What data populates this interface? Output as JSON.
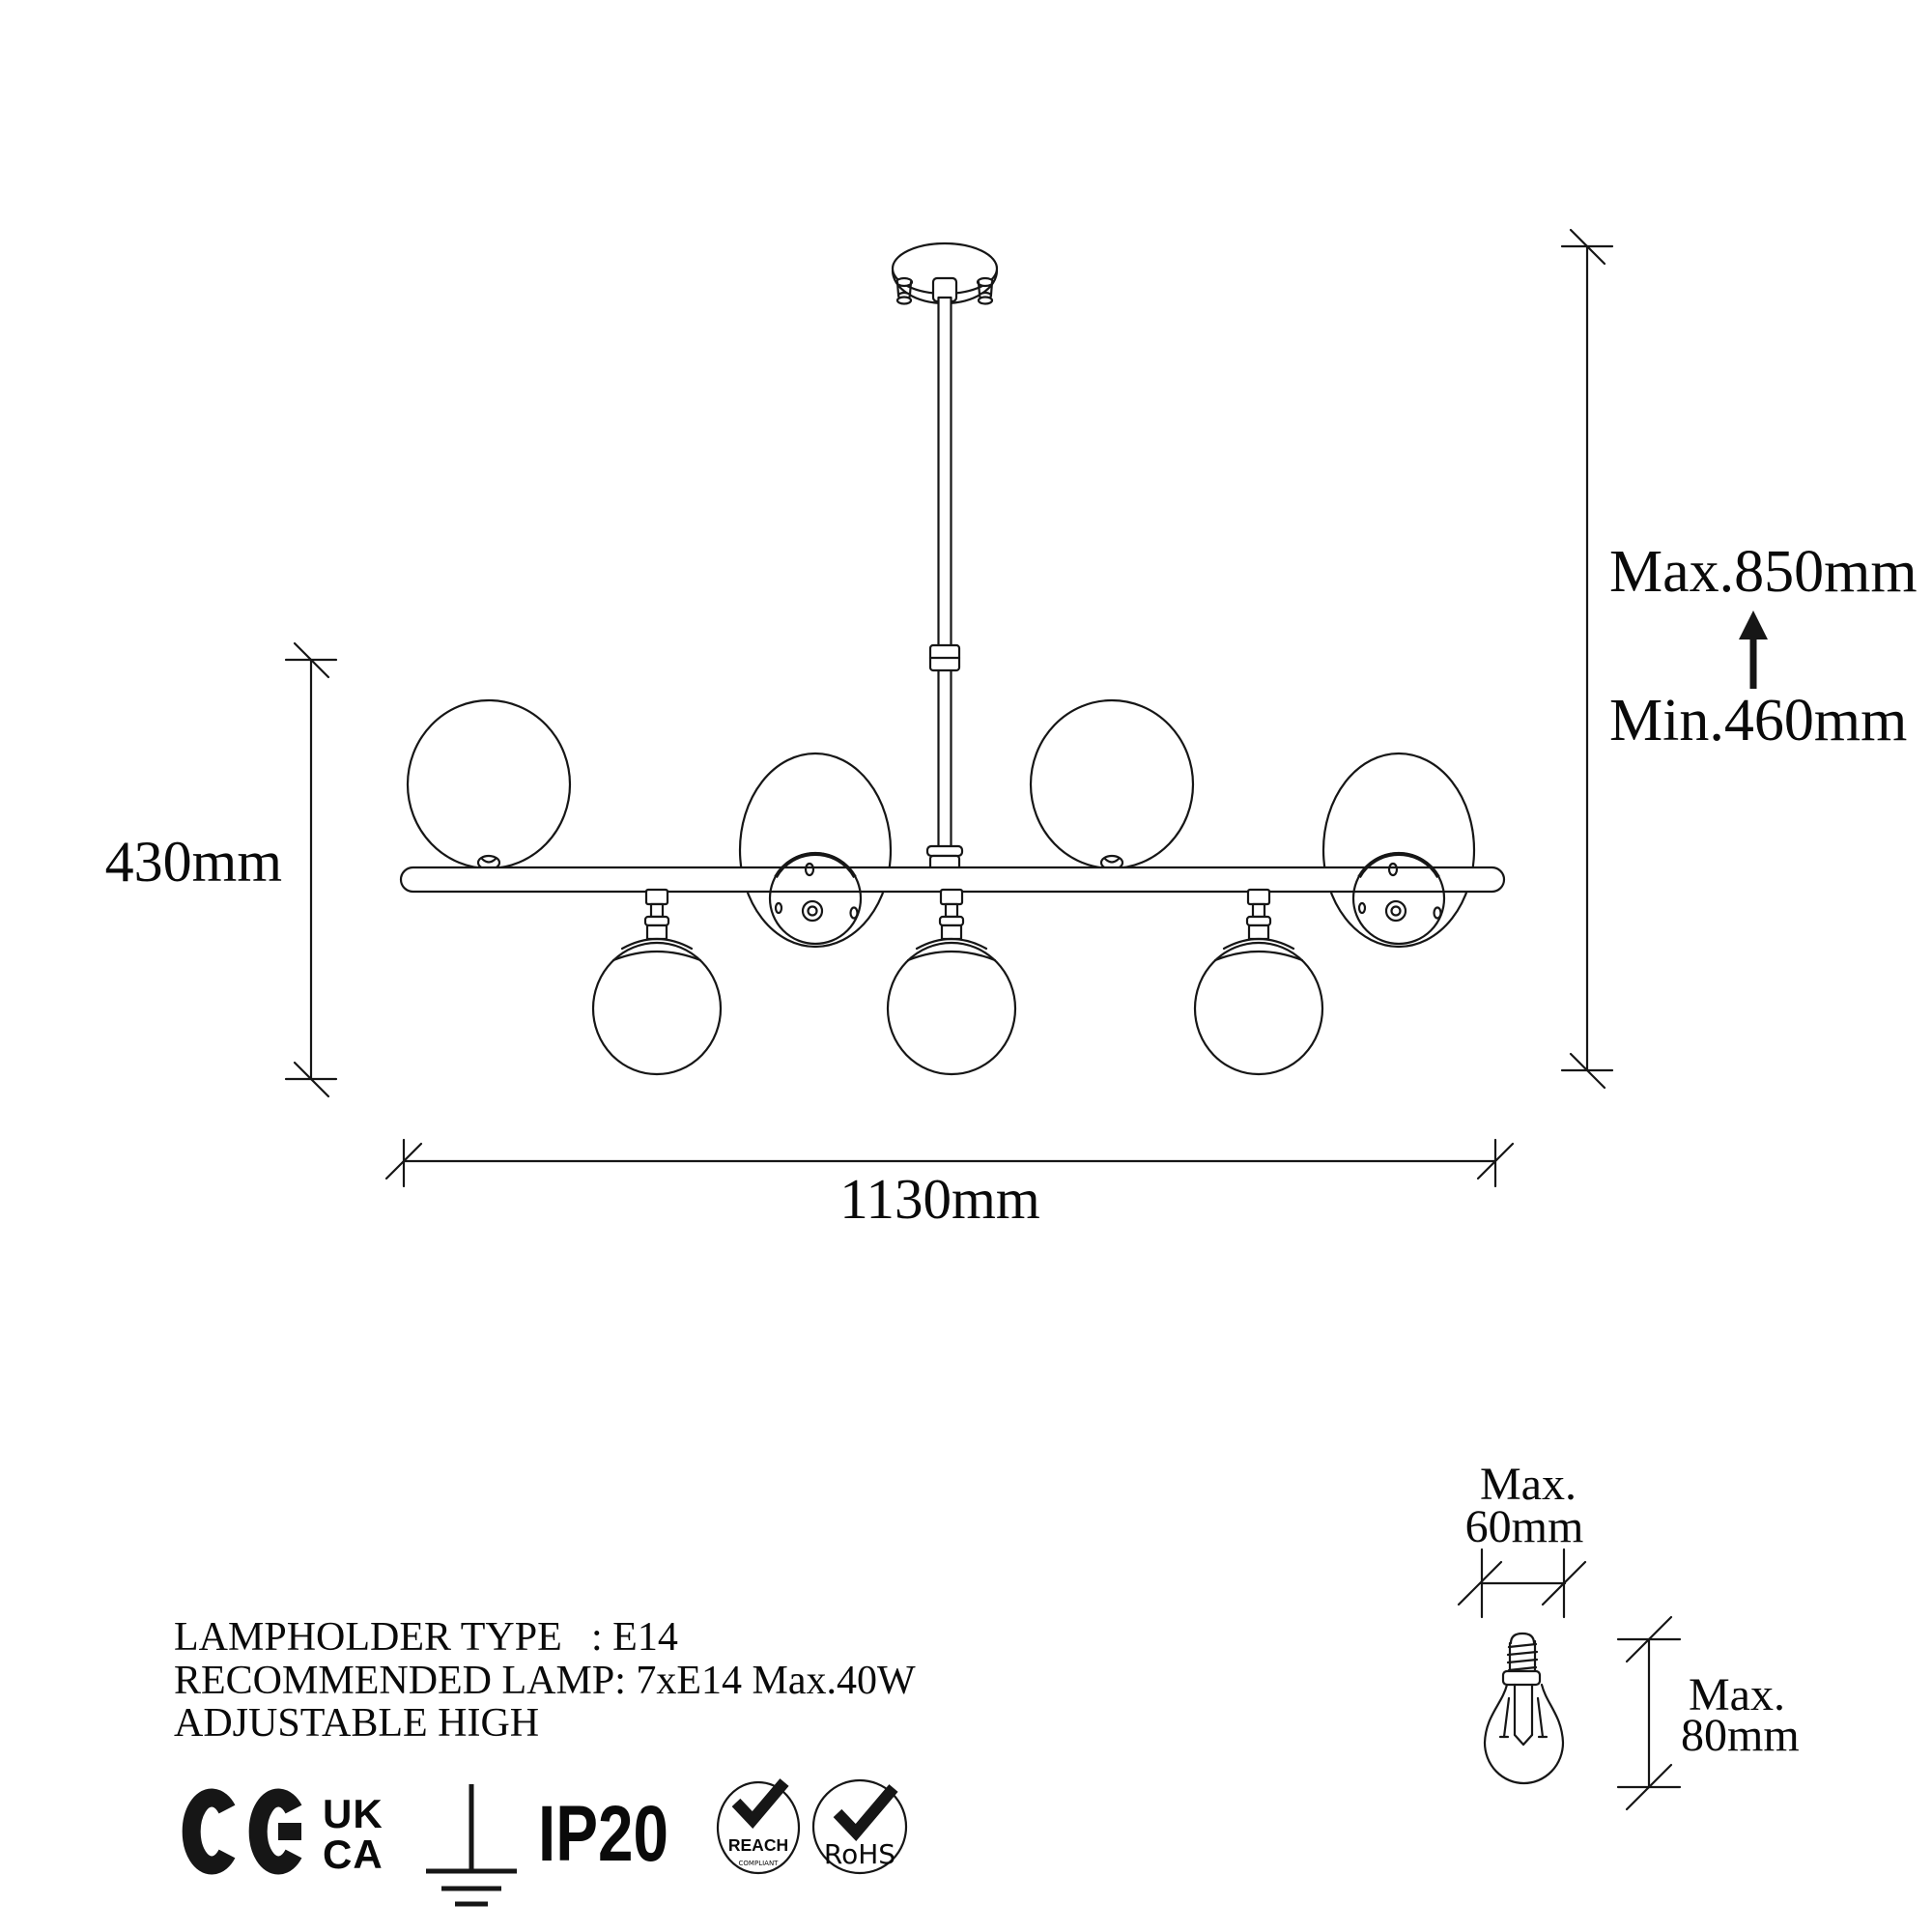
{
  "drawing": {
    "background": "#ffffff",
    "line_color": "#161616",
    "lamp": {
      "type": "linear-chandelier-technical-drawing",
      "upper_globes": 4,
      "lower_globes": 3
    },
    "dimensions": {
      "total_width": "1130mm",
      "body_height": "430mm",
      "hanging_max": "Max.850mm",
      "hanging_min": "Min.460mm"
    },
    "bulb_detail": {
      "diameter_prefix": "Max.",
      "diameter": "60mm",
      "height_prefix": "Max.",
      "height": "80mm"
    }
  },
  "specs": {
    "line1_label": "LAMPHOLDER TYPE",
    "line1_value": ": E14",
    "line2": "RECOMMENDED LAMP: 7xE14 Max.40W",
    "line3": "ADJUSTABLE HIGH"
  },
  "certifications": {
    "ce": "CE",
    "ukca_top": "UK",
    "ukca_bottom": "CA",
    "ip_rating": "IP20",
    "reach": "REACH",
    "reach_sub": "COMPLIANT",
    "rohs": "RoHS"
  }
}
